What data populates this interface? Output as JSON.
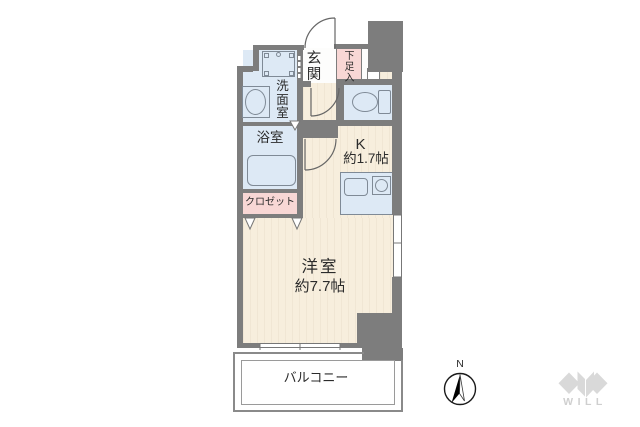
{
  "floorplan": {
    "rooms": {
      "genkan": {
        "label": "玄関"
      },
      "shoe_storage": {
        "label": "下足入"
      },
      "washroom": {
        "label": "洗面室"
      },
      "bathroom": {
        "label": "浴室"
      },
      "closet": {
        "label": "クロゼット"
      },
      "kitchen": {
        "label": "K",
        "size": "約1.7帖"
      },
      "western_room": {
        "label": "洋室",
        "size": "約7.7帖"
      },
      "balcony": {
        "label": "バルコニー"
      }
    },
    "compass": {
      "north_label": "N"
    },
    "branding": {
      "logo_text": "WILL"
    },
    "colors": {
      "wall": "#7d7d7d",
      "floor_wood": "#f7eedd",
      "wet_area": "#dde9f5",
      "accent_pink": "#f8d7d5",
      "genkan_floor": "#fdfdfc",
      "balcony_line": "#8a8a8a",
      "logo_gray": "#d9d9d9"
    }
  }
}
